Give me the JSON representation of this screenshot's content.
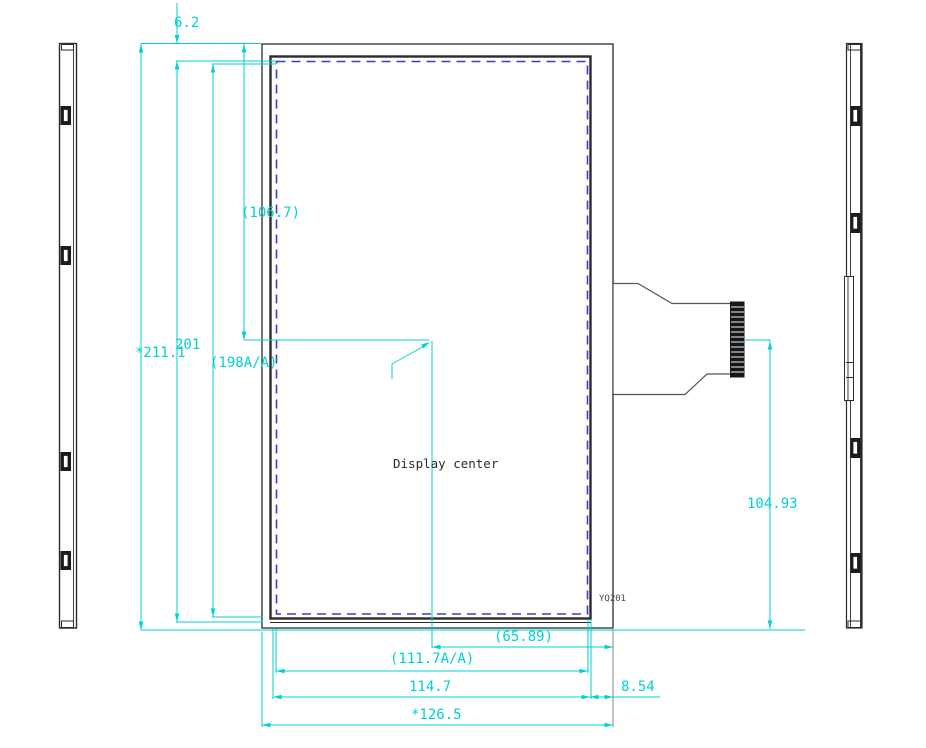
{
  "dimensions": {
    "top_offset": "6.2",
    "overall_height": "*211.1",
    "outline_height": "201",
    "active_area_height": "(198A/A)",
    "center_height_from_top": "(106.7)",
    "connector_center_height": "104.93",
    "center_to_right_edge": "(65.89)",
    "active_area_width": "(111.7A/A)",
    "glass_width": "114.7",
    "right_edge_offset": "8.54",
    "overall_width": "*126.5"
  },
  "annotations": {
    "display_center": "Display center",
    "part_label": "YQ201"
  },
  "colors": {
    "dimension_line": "#00d2d2",
    "outline": "#2b2b2b",
    "active_area_border": "#3c3ccd",
    "fpc_connector_fill": "#161616",
    "background": "#ffffff"
  }
}
